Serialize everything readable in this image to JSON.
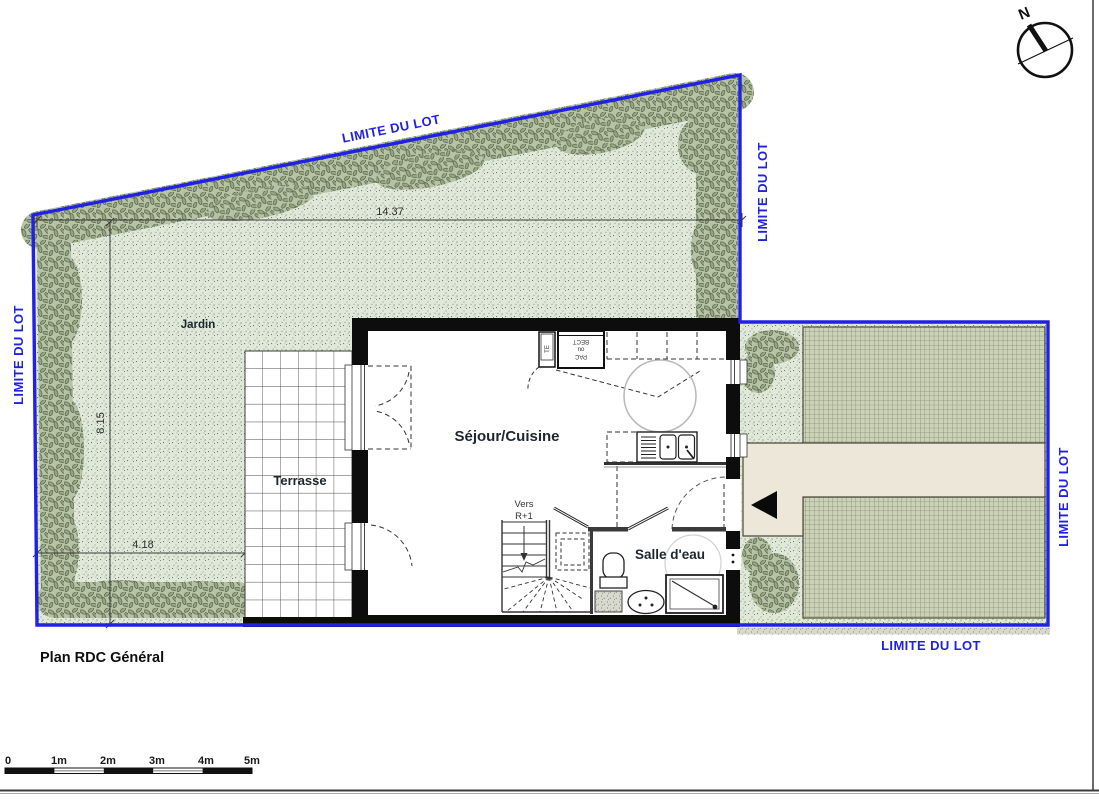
{
  "sheet": {
    "title": "Plan RDC Général"
  },
  "boundary": {
    "label": "LIMITE DU LOT",
    "color": "#2121e6"
  },
  "areas": {
    "garden": "Jardin",
    "terrace": "Terrasse",
    "living": "Séjour/Cuisine",
    "bathroom": "Salle d'eau",
    "stair_dir_line1": "Vers",
    "stair_dir_line2": "R+1"
  },
  "closets": {
    "pac_line1": "PAC",
    "pac_line2": "ou",
    "pac_line3": "BECT",
    "te": "TE"
  },
  "dimensions": {
    "top_width_m": "14.37",
    "left_height_m": "8.15",
    "terrace_width_m": "4.18"
  },
  "compass": {
    "north": "N"
  },
  "scale_bar": {
    "ticks": [
      "0",
      "1m",
      "2m",
      "3m",
      "4m",
      "5m"
    ]
  },
  "colors": {
    "boundary_blue": "#2121e6",
    "garden_green": "#e0e9d9",
    "hatch_green": "#ccd3ba",
    "path_beige": "#ece7d8"
  }
}
